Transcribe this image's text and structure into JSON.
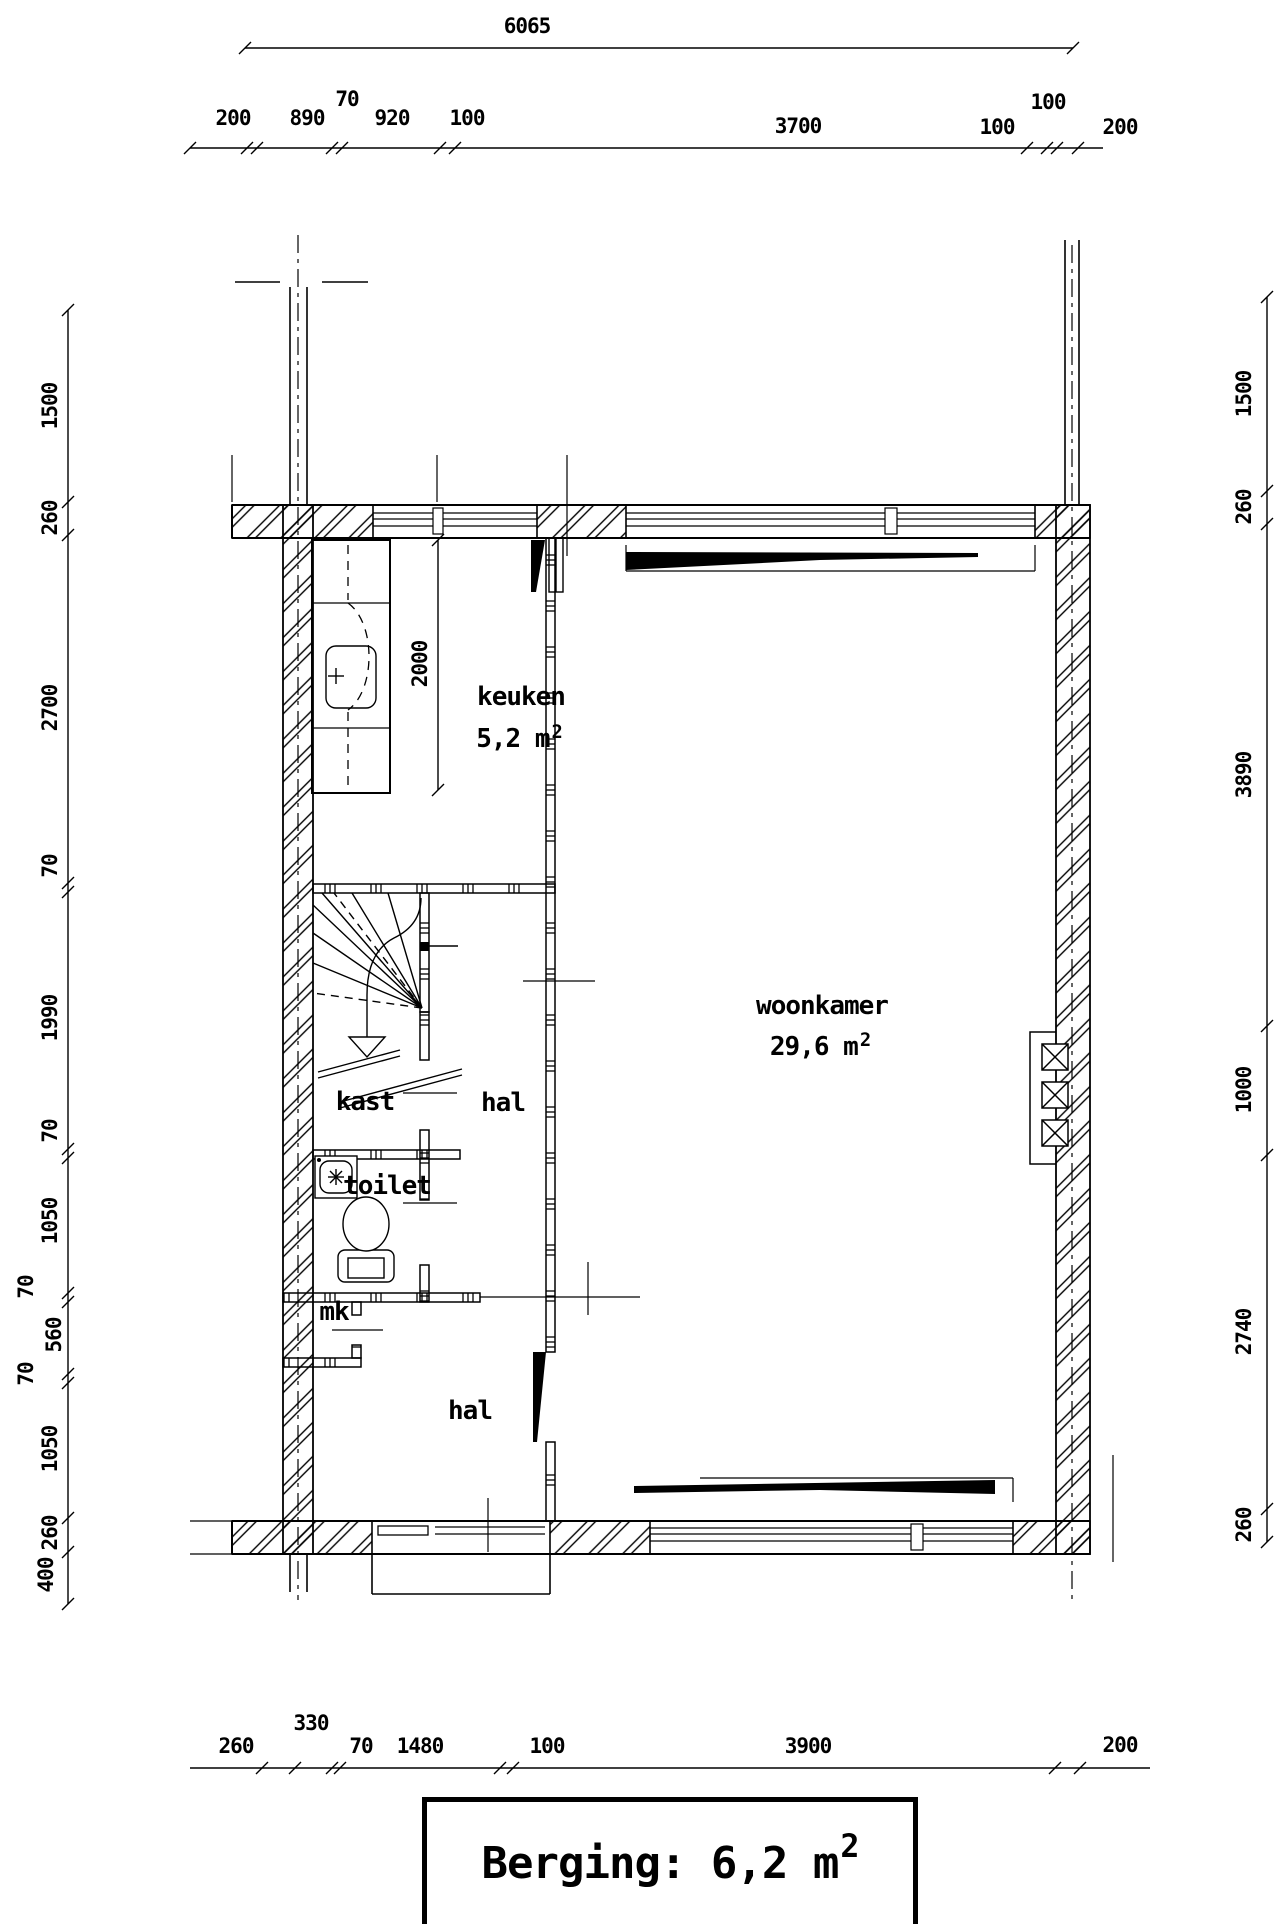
{
  "page": {
    "paper_color": "#ffffff",
    "ink_color": "#000000"
  },
  "plan": {
    "rooms": {
      "keuken": {
        "name": "keuken",
        "area_value": "5,2 m",
        "area_sup": "2"
      },
      "woonkamer": {
        "name": "woonkamer",
        "area_value": "29,6 m",
        "area_sup": "2"
      },
      "kast": {
        "name": "kast"
      },
      "hal_upper": {
        "name": "hal"
      },
      "toilet": {
        "name": "toilet"
      },
      "mk": {
        "name": "mk"
      },
      "hal_lower": {
        "name": "hal"
      }
    },
    "dimensions": {
      "top_total": "6065",
      "top_row": [
        "200",
        "890",
        "70",
        "920",
        "100",
        "3700",
        "100",
        "100",
        "200"
      ],
      "left_col": [
        "1500",
        "260",
        "2700",
        "70",
        "1990",
        "70",
        "1050",
        "70",
        "560",
        "70",
        "1050",
        "260",
        "400"
      ],
      "right_col": [
        "1500",
        "260",
        "3890",
        "1000",
        "2740",
        "260"
      ],
      "bottom_row": [
        "260",
        "330",
        "70",
        "1480",
        "100",
        "3900",
        "200"
      ],
      "keuken_depth": "2000"
    },
    "title_box": {
      "label": "Berging: 6,2 m",
      "sup": "2"
    }
  }
}
